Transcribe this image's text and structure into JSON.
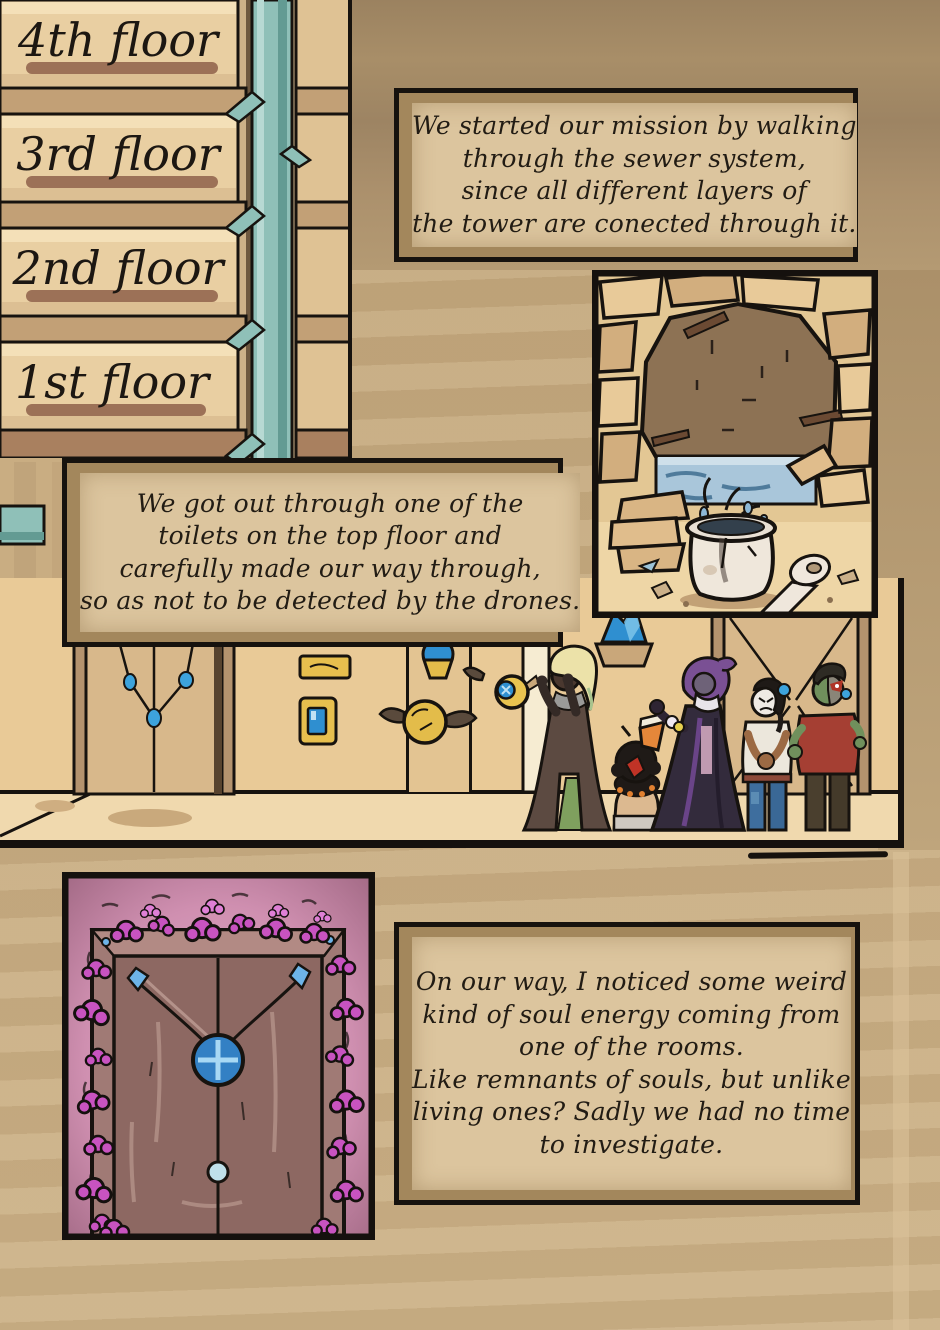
{
  "page": {
    "background_color": "#c6ab81",
    "background_dark_color": "#a08765",
    "ink_color": "#17130f"
  },
  "floors_panel": {
    "labels": [
      "4th floor",
      "3rd floor",
      "2nd floor",
      "1st floor"
    ],
    "pipe_color": "#8fc0b8",
    "plank_color": "#e9cfa2"
  },
  "narration": {
    "box1": {
      "lines": [
        "We started our mission by walking",
        "through the sewer system,",
        "since all different layers of",
        "the tower are conected through it."
      ]
    },
    "box2": {
      "lines": [
        "We got out through one of the",
        "toilets on the top floor and",
        "carefully made our way through,",
        "so as not to be detected by the drones."
      ]
    },
    "box3": {
      "lines": [
        "On our way, I noticed some weird",
        "kind of soul energy coming from",
        "one of the rooms.",
        "Like remnants of souls, but unlike",
        "living ones? Sadly we had no time",
        "to investigate."
      ]
    }
  },
  "illustrations": {
    "sewer_panel": {
      "water_color": "#a9c6da",
      "stone_color": "#e8ca99",
      "hole_color": "#8d7254",
      "toilet_color": "#efe7db"
    },
    "hallway_panel": {
      "wall_color": "#e9ca97",
      "crystal_color": "#2f8fd0",
      "drone_color": "#e9c34f"
    },
    "glowing_door_panel": {
      "glow_color": "#d892bb",
      "moss_color": "#c853c0",
      "door_color": "#8d6862",
      "gem_color": "#3380c4"
    }
  }
}
